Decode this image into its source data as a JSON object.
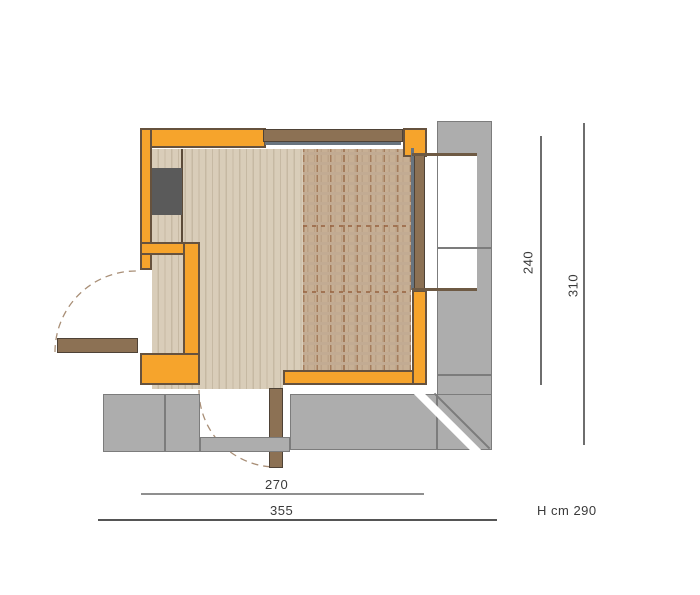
{
  "drawing": {
    "kind": "floor-plan-top-view",
    "height_note": "H cm 290",
    "dimensions": {
      "inner_width": "270",
      "outer_width": "355",
      "inner_depth": "240",
      "outer_depth": "310"
    }
  },
  "elements": {
    "walls": "painted masonry walls",
    "floor": "wood plank flooring",
    "overlay": "overhead deck / roof projection (dashed)",
    "plinth": "concrete base slabs",
    "doors": [
      "entry door with swing arc (left)",
      "service door with swing arc (bottom)"
    ],
    "windows": [
      "top clerestory window band",
      "right sliding glazed window into concrete pocket"
    ],
    "appliance": "dark utility block in closet niche"
  },
  "colors": {
    "wall_orange": "#F6A42C",
    "wall_outline": "#66523E",
    "floor_wood": "#D9CDB9",
    "overlay_brown": "#AB7E5A",
    "concrete_gray": "#ADADAD",
    "door_wood": "#8C7154",
    "glass": "#68747F",
    "appliance_dark": "#5A5A5A",
    "dimension_text": "#3A3A3A"
  }
}
